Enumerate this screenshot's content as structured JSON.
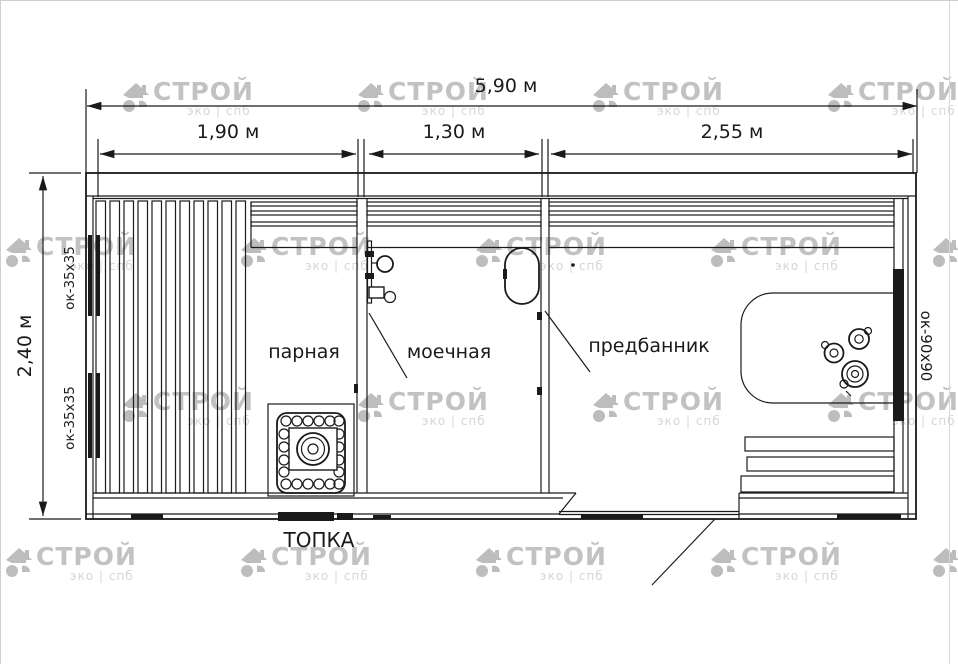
{
  "watermark": {
    "brand": "СТРОЙ",
    "sub": "эко | спб",
    "brand_color": "#c2c2c2",
    "sub_color": "#d6d6d6",
    "icon_color": "#bdbdbd",
    "tiles": [
      {
        "x": 120,
        "y": 78
      },
      {
        "x": 355,
        "y": 78
      },
      {
        "x": 590,
        "y": 78
      },
      {
        "x": 825,
        "y": 78
      },
      {
        "x": 3,
        "y": 233
      },
      {
        "x": 238,
        "y": 233
      },
      {
        "x": 473,
        "y": 233
      },
      {
        "x": 708,
        "y": 233
      },
      {
        "x": 930,
        "y": 233
      },
      {
        "x": 120,
        "y": 388
      },
      {
        "x": 355,
        "y": 388
      },
      {
        "x": 590,
        "y": 388
      },
      {
        "x": 825,
        "y": 388
      },
      {
        "x": 3,
        "y": 543
      },
      {
        "x": 238,
        "y": 543
      },
      {
        "x": 473,
        "y": 543
      },
      {
        "x": 708,
        "y": 543
      },
      {
        "x": 930,
        "y": 543
      }
    ]
  },
  "dimensions": {
    "overall_width": "5,90 м",
    "steam_width": "1,90 м",
    "wash_width": "1,30 м",
    "ante_width": "2,55 м",
    "overall_depth": "2,40 м"
  },
  "rooms": {
    "steam": "парная",
    "wash": "моечная",
    "ante": "предбанник"
  },
  "equipment": {
    "furnace": "ТОПКА"
  },
  "windows": {
    "left_top": "ок-35x35",
    "left_bottom": "ок-35x35",
    "right": "ок-90x90"
  }
}
